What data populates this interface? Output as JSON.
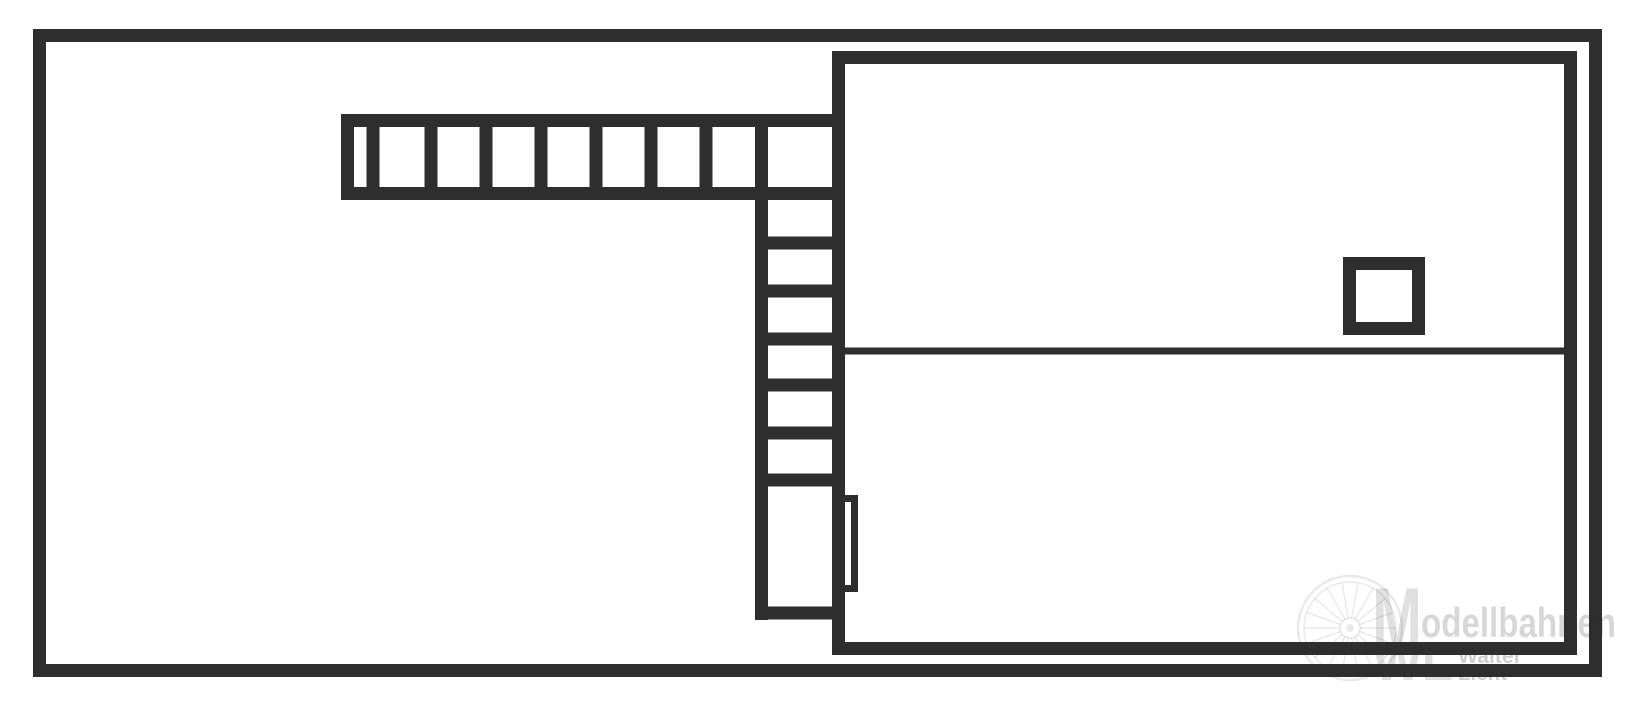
{
  "canvas": {
    "background": "#ffffff"
  },
  "diagram": {
    "line_color": "#2e2e2e",
    "outer_frame": {
      "x": 33,
      "y": 29,
      "w": 1569,
      "h": 648,
      "stroke": 13
    },
    "main_building": {
      "x": 832,
      "y": 51,
      "w": 745,
      "h": 604,
      "stroke": 13
    },
    "partition_line": {
      "x1": 845,
      "x2": 1570,
      "y": 351,
      "stroke": 7
    },
    "small_square": {
      "x": 1343,
      "y": 257,
      "w": 82,
      "h": 78,
      "stroke": 13
    },
    "top_ladder": {
      "x": 341,
      "y": 114,
      "w": 504,
      "h": 86,
      "stroke": 13,
      "rung_centers_x": [
        373,
        431,
        486,
        541,
        596,
        651,
        706
      ],
      "rung_width": 13
    },
    "side_ladder": {
      "rail": {
        "x": 755,
        "y": 114,
        "w": 13,
        "h": 506
      },
      "rungs_x": 755,
      "rungs_w": 90,
      "rungs_h": 13,
      "rung_centers_y": [
        243,
        291,
        339,
        385,
        433,
        480,
        613
      ]
    },
    "door_niche": {
      "x": 838,
      "y": 495,
      "w": 20,
      "h": 97,
      "stroke": 7
    }
  },
  "watermark": {
    "monogram_top": "M",
    "brand_suffix": "odellbahnen",
    "monogram_bottom": "WL",
    "owner_first_name": "Walter",
    "owner_last_name": "Licht",
    "logo_color": "rgba(45,45,45,0.15)",
    "brand_color": "rgba(45,45,45,0.19)",
    "name_color": "rgba(45,45,45,0.23)",
    "wheel": {
      "cx": 1350,
      "cy": 628,
      "r": 52,
      "spokes": 18,
      "color": "rgba(45,45,45,0.10)"
    }
  }
}
